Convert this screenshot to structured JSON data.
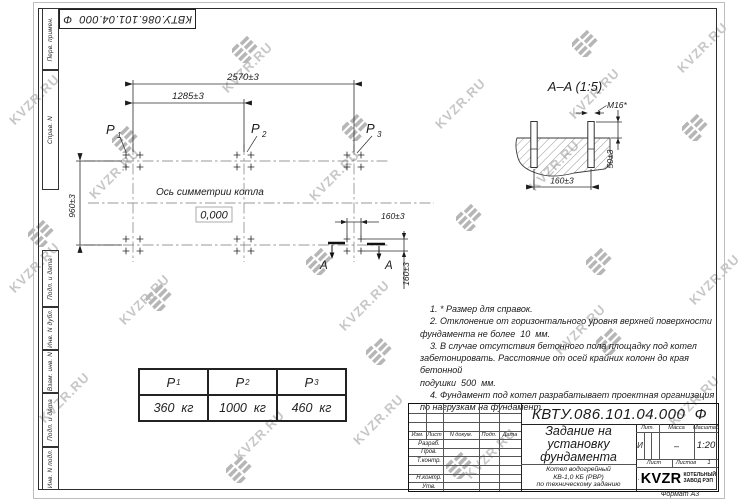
{
  "watermark": {
    "text": "KVZR.RU"
  },
  "corner_stamp": {
    "doc_number": "КВТУ.086.101.04.000  Ф"
  },
  "margin_labels": {
    "perv_primen": "Перв. примен.",
    "sprav_n": "Справ. N",
    "podp_data_1": "Подп. и дата",
    "inv_n_dubl": "Инв. N дубл.",
    "vzam_inv_n": "Взам. инв. N",
    "podp_data_2": "Подп. и дата",
    "inv_n_podl": "Инв. N подл."
  },
  "plan": {
    "dim_overall": "2570±3",
    "dim_half": "1285±3",
    "dim_vertical": "960±3",
    "dim_bolt_h": "160±3",
    "dim_bolt_v": "160±3",
    "axis_label": "Ось симметрии котла",
    "level_mark": "0,000",
    "section_mark": "A",
    "p_labels": [
      {
        "base": "P",
        "sub": "1"
      },
      {
        "base": "P",
        "sub": "2"
      },
      {
        "base": "P",
        "sub": "3"
      }
    ]
  },
  "section": {
    "title": "A–A  (1:5)",
    "bolt_thread": "M16*",
    "dim_protrusion": "50±3",
    "dim_spacing": "160±3"
  },
  "loads_table": {
    "headers": [
      {
        "base": "P",
        "sub": "1"
      },
      {
        "base": "P",
        "sub": "2"
      },
      {
        "base": "P",
        "sub": "3"
      }
    ],
    "values": [
      "360  кг",
      "1000  кг",
      "460  кг"
    ]
  },
  "notes": {
    "text": "    1. * Размер для справок.\n    2. Отклонение от горизонтального уровня верхней поверхности\nфундамента не более  10  мм.\n    3. В случае отсутствия бетонного пола площадку под котел\nзабетонировать. Расстояние от осей крайних колонн до края бетонной\nподушки  500  мм.\n    4. Фундамент под котел разрабатывает проектная организация\nпо нагрузкам на фундамент."
  },
  "title_block": {
    "doc_number": "КВТУ.086.101.04.000  Ф",
    "title": "Задание на\nустановку\nфундамента",
    "subtitle": "Котел водогрейный\nКВ-1,0 КБ (РВР)\nпо техническому заданию",
    "col_izm": "Изм.",
    "col_list": "Лист",
    "col_ndokum": "N докум.",
    "col_podp": "Подп.",
    "col_data": "Дата",
    "row_razrab": "Разраб.",
    "row_prov": "Пров.",
    "row_tkontr": "Т.контр.",
    "row_nkontr": "Н.контр.",
    "row_utv": "Утв.",
    "lit_header": "Лит.",
    "lit_value": "И",
    "massa_header": "Масса",
    "massa_value": "–",
    "masshtab_header": "Масштаб",
    "masshtab_value": "1:20",
    "list_label": "Лист",
    "listov_label": "Листов",
    "listov_value": "1",
    "brand": "KVZR",
    "brand_sub": "КОТЕЛЬНЫЙ\nЗАВОД РЭП",
    "format_label": "Формат А3"
  }
}
